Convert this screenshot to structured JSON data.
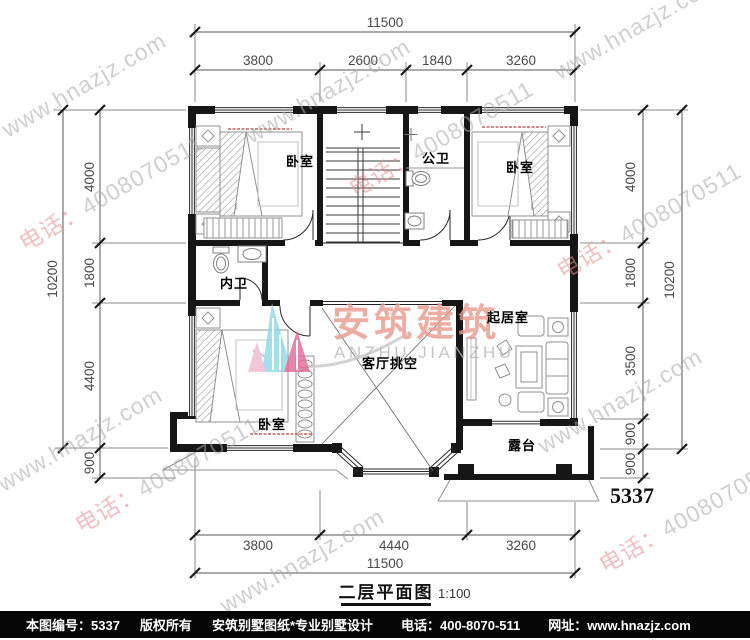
{
  "title": {
    "name": "二层平面图",
    "scale": "1:100"
  },
  "sheet_no": "5337",
  "rooms": {
    "bedroom_tl": "卧室",
    "bath_public": "公卫",
    "bedroom_tr": "卧室",
    "bath_ensuite": "内卫",
    "living": "起居室",
    "void": "客厅挑空",
    "bedroom_bl": "卧室",
    "terrace": "露台"
  },
  "dimensions": {
    "top": {
      "total": "11500",
      "segments": [
        "3800",
        "2600",
        "1840",
        "3260"
      ]
    },
    "bottom": {
      "total": "11500",
      "segments": [
        "3800",
        "4440",
        "3260"
      ]
    },
    "left": {
      "total": "10200",
      "segments": [
        "4000",
        "1800",
        "4400",
        "900"
      ]
    },
    "right": {
      "total": "10200",
      "segments": [
        "4000",
        "1800",
        "3500",
        "900",
        "900"
      ]
    }
  },
  "watermark": {
    "url": "www.hnazjz.com",
    "tel_label": "电话：",
    "tel_number": "4008070511"
  },
  "logo": {
    "cn": "安筑建筑",
    "en": "ANZHU JIANZHU"
  },
  "footer": {
    "sheet": "本图编号：5337",
    "copyright": "版权所有",
    "studio": "安筑别墅图纸*专业别墅设计",
    "phone": "电话：400-8070-511",
    "site": "网址：www.hnazjz.com"
  },
  "colors": {
    "wall": "#161616",
    "dim_text": "#4a4a4a",
    "logo_cyan": "#8fd8e8",
    "logo_pink": "#e06a95",
    "logo_text": "#e89a8e",
    "watermark_gray": "#a8a8a8",
    "watermark_pink": "#e48c8c"
  }
}
